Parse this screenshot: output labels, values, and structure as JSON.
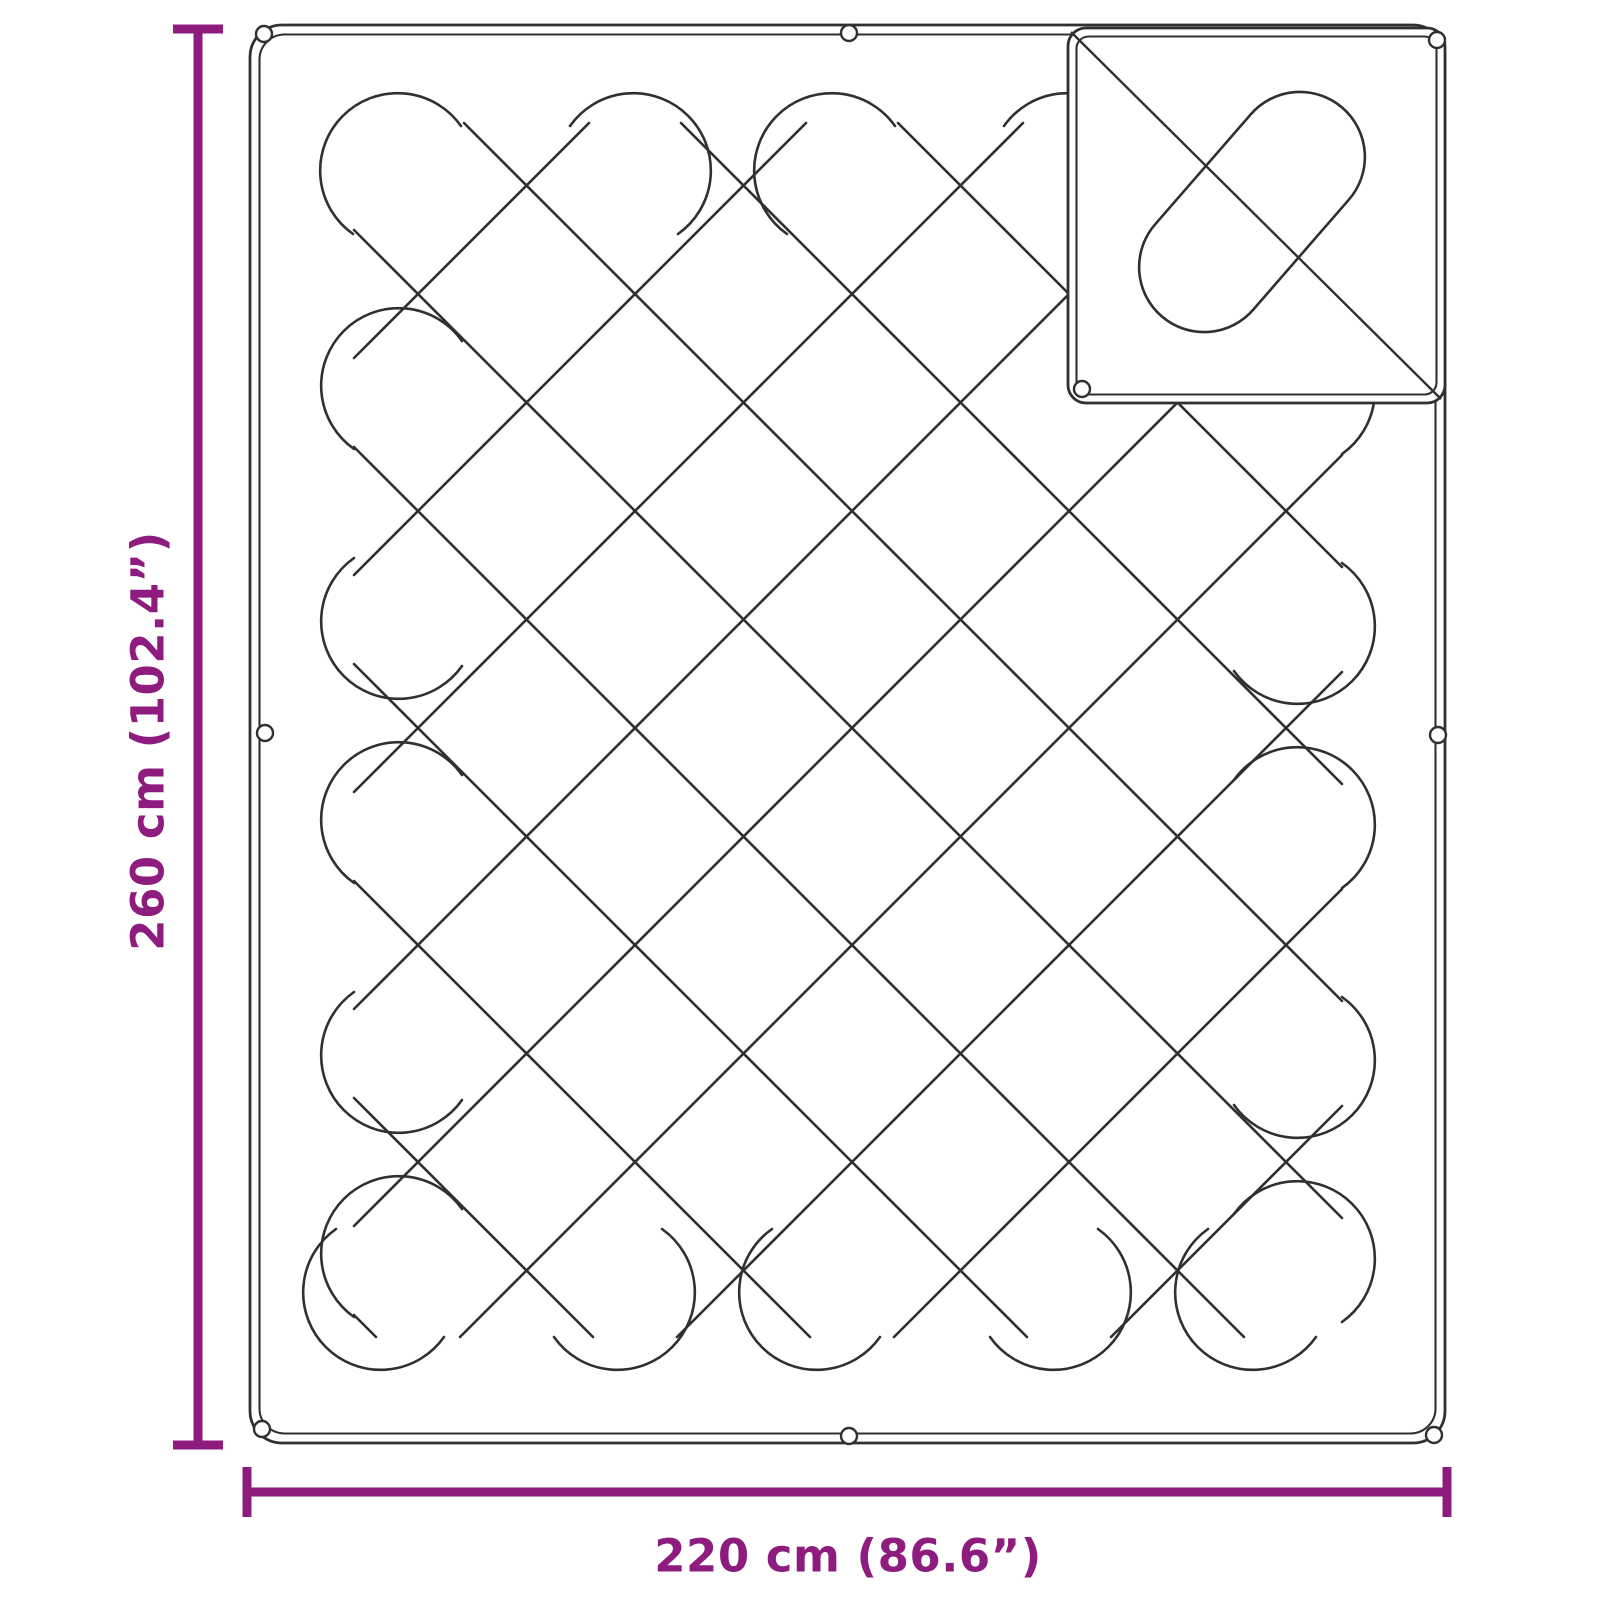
{
  "page": {
    "background": "#ffffff",
    "kind": "product dimension line drawing"
  },
  "diagram": {
    "subject": "quilted blanket with diamond stitching, folded corner flap and edge eyelets",
    "colors": {
      "dimension_accent": "#8E1C7E",
      "drawing_line": "#303030",
      "background": "#ffffff"
    },
    "dimensions": {
      "height": {
        "label": "260 cm (102.4”)",
        "value_cm": 260,
        "value_in": 102.4
      },
      "width": {
        "label": "220 cm (86.6”)",
        "value_cm": 220,
        "value_in": 86.6
      }
    },
    "features": {
      "eyelet_count": 9,
      "quilting": "diagonal diamond grid with rounded serpentine loop turns",
      "corner_flap": "folded square corner with diagonal seam and capsule quilt loop"
    }
  }
}
